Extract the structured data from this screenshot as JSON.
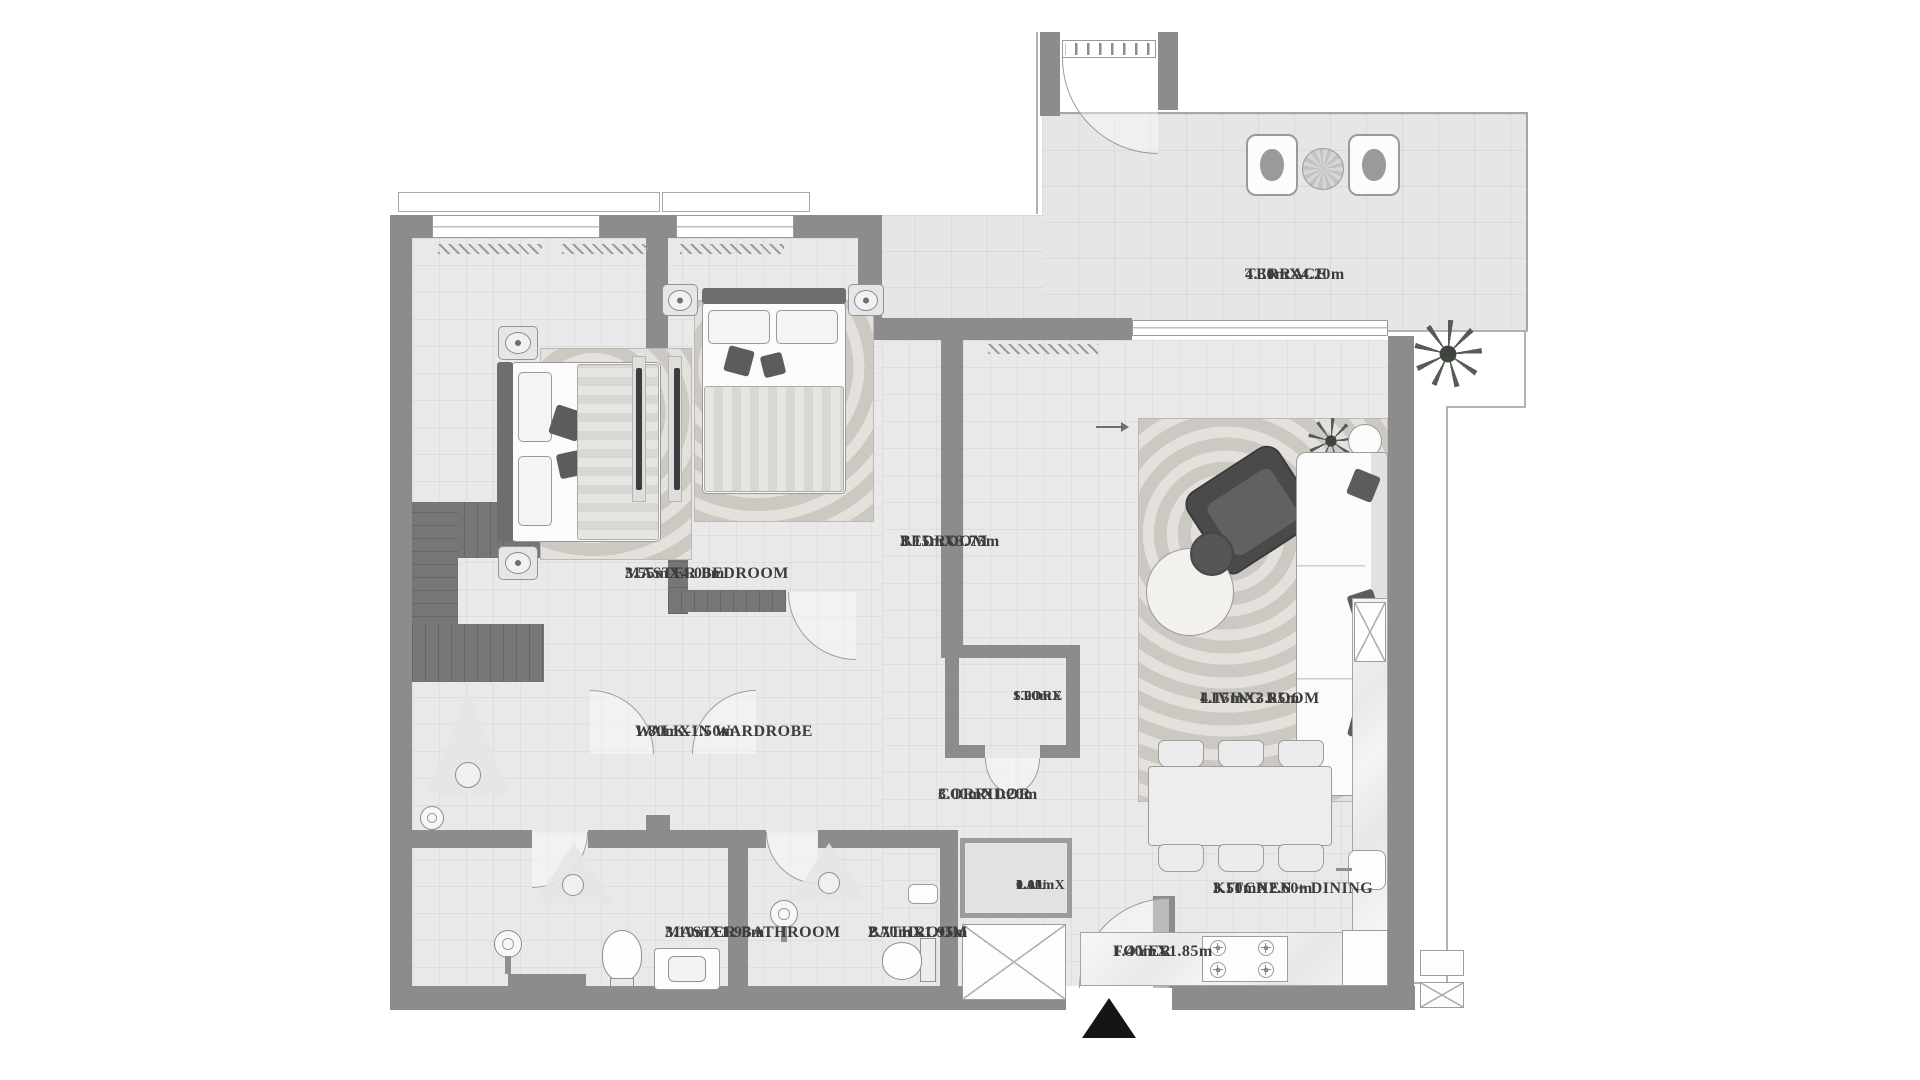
{
  "plan_title": "Apartment Floor Plan",
  "rooms": {
    "terrace": {
      "name": "TERRACE",
      "dims": "4.30mX4.20m"
    },
    "master_bedroom": {
      "name": "MASTER BEDROOM",
      "dims": "3.55mX4.00m"
    },
    "bedroom": {
      "name": "BEDROOM",
      "dims": "3.15mX3.75m"
    },
    "walk_in_wardrobe": {
      "name": "WALK-IN WARDROBE",
      "dims": "1.80mX1.50m"
    },
    "store": {
      "name": "STORE",
      "dims_line1": "1.20mX",
      "dims_line2": "1.00m"
    },
    "corridor": {
      "name": "CORRIDOR",
      "dims": "3.00mX1.20m"
    },
    "living_room": {
      "name": "LIVING ROOM",
      "dims": "4.15mX3.85m"
    },
    "laundry": {
      "name": "LAU.",
      "dims_line1": "1.05mX",
      "dims_line2": "0.10m"
    },
    "master_bathroom": {
      "name": "MASTER BATHROOM",
      "dims": "3.10mX1.95m"
    },
    "bathroom": {
      "name": "BATHROOM",
      "dims": "2.70mX1.95m"
    },
    "foyer": {
      "name": "FOYER",
      "dims": "1.40mX1.85m"
    },
    "kitchen_dining": {
      "name": "KITCHEN + DINING",
      "dims": "3.50mX2.60m"
    }
  },
  "colors": {
    "wall": "#8c8c8c",
    "floor": "#e9e9e9",
    "cabinet": "#767676",
    "entry_marker": "#151515",
    "label_text": "#3c3c3c"
  },
  "icons": {
    "entry": "entry-triangle-icon",
    "flow": "right-arrow-icon"
  }
}
